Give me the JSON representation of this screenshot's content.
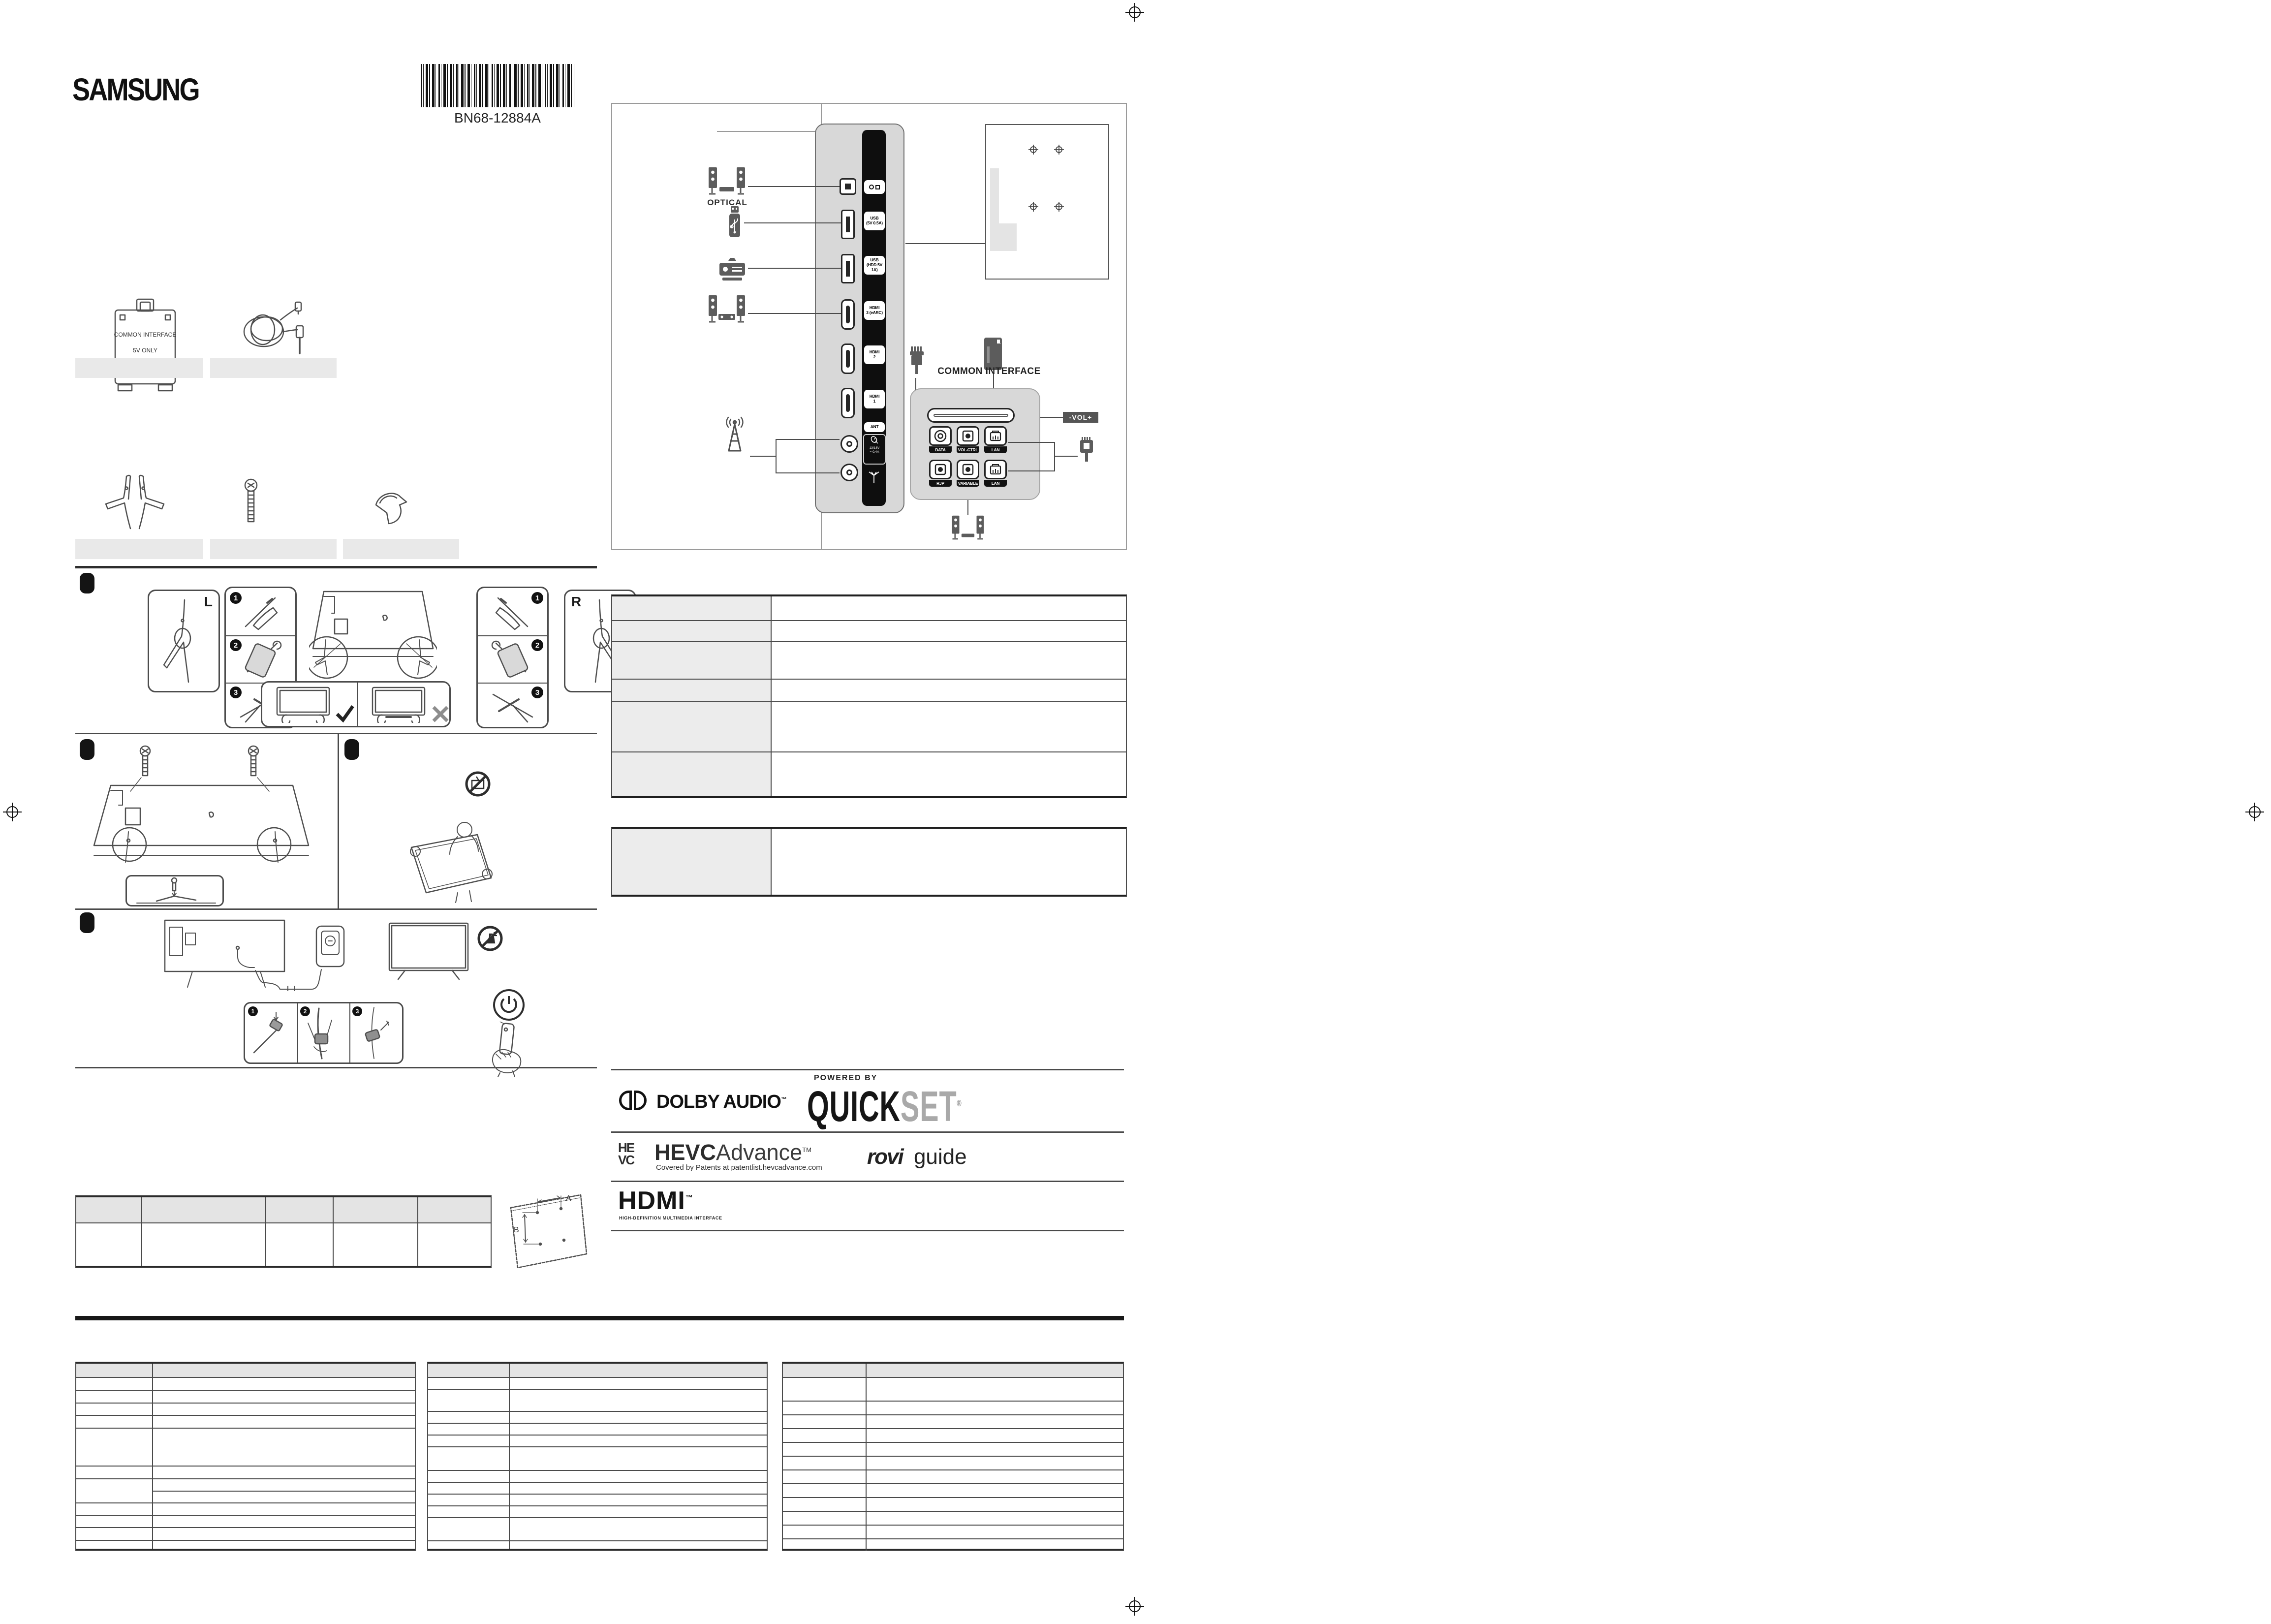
{
  "brand": "SAMSUNG",
  "barcode_text": "BN68-12884A",
  "accessories": {
    "ci_adapter_line1": "COMMON INTERFACE",
    "ci_adapter_line2": "5V ONLY"
  },
  "assembly": {
    "left": "L",
    "right": "R",
    "step1": "1",
    "step2": "2",
    "step3": "3"
  },
  "wall": {
    "dim_a": "A",
    "dim_b": "B"
  },
  "panel": {
    "optical_label": "OPTICAL",
    "usb1_l1": "USB",
    "usb1_l2": "(5V 0.5A)",
    "usb2_l1": "USB",
    "usb2_l2": "(HDD 5V 1A)",
    "hdmi3_l1": "HDMI",
    "hdmi3_l2": "3 (eARC)",
    "hdmi2_l1": "HDMI",
    "hdmi2_l2": "2",
    "hdmi1_l1": "HDMI",
    "hdmi1_l2": "1",
    "ant_label": "ANT",
    "sat_l1": "13/18V",
    "sat_l2": "= 0.4A",
    "common_interface": "COMMON INTERFACE",
    "vol_badge": "-VOL+",
    "btn_data": "DATA",
    "btn_volctrl": "VOL-CTRL",
    "btn_lan1": "LAN",
    "btn_rjp": "RJP",
    "btn_variable": "VARIABLE",
    "btn_lan2": "LAN"
  },
  "logos": {
    "dolby": "DOLBY AUDIO",
    "dolby_tm": "™",
    "powered_by": "POWERED BY",
    "quick": "QUICK",
    "set": "SET",
    "reg": "®",
    "hevc_he": "HE",
    "hevc_vc": "VC",
    "hevc_bold": "HEVC",
    "hevc_light": "Advance",
    "hevc_tm": "TM",
    "hevc_sub": "Covered by Patents at patentlist.hevcadvance.com",
    "rovi": "rovi",
    "guide": "guide",
    "hdmi": "HDMI",
    "hdmi_tm": "™",
    "hdmi_sub": "HIGH-DEFINITION MULTIMEDIA INTERFACE"
  }
}
